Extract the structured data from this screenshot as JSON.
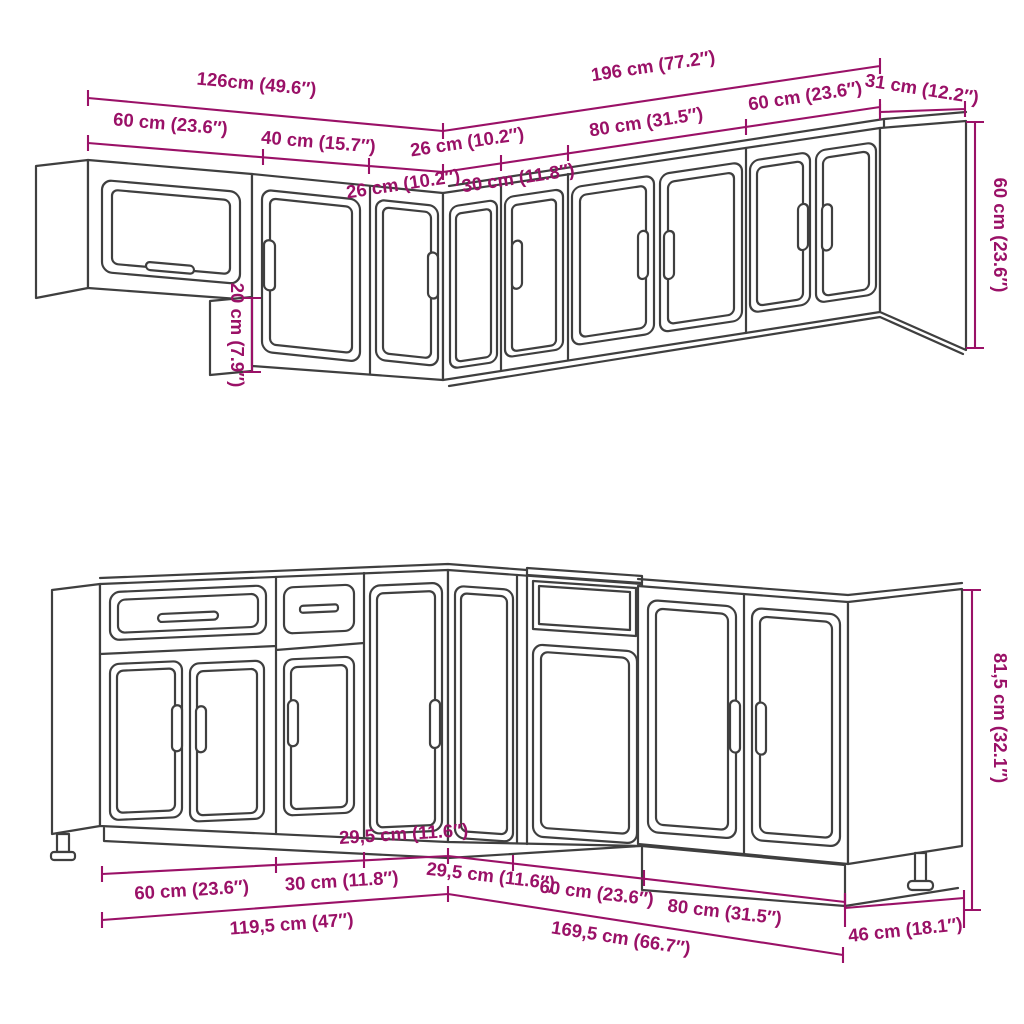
{
  "theme": {
    "dimension_color": "#9a1167",
    "line_art_color": "#3f3f3f",
    "background": "#ffffff"
  },
  "dimensions": {
    "top": {
      "overall_left": "126cm (49.6″)",
      "overall_right": "196 cm (77.2″)",
      "end_panel_depth": "31 cm (12.2″)",
      "seg_60_left": "60 cm (23.6″)",
      "seg_40": "40 cm (15.7″)",
      "seg_26_a": "26 cm (10.2″)",
      "seg_26_b": "26 cm (10.2″)",
      "seg_30": "30 cm (11.8″)",
      "seg_80": "80 cm (31.5″)",
      "seg_60_right": "60 cm (23.6″)",
      "height": "60 cm (23.6″)",
      "offset_height": "20 cm (7.9″)"
    },
    "bottom": {
      "seg_60_left": "60 cm (23.6″)",
      "seg_30": "30 cm (11.8″)",
      "seg_295_left": "29,5 cm (11.6″)",
      "seg_295_right": "29,5 cm (11.6″)",
      "seg_60_right": "60 cm (23.6″)",
      "seg_80": "80 cm (31.5″)",
      "overall_left": "119,5 cm (47″)",
      "overall_right": "169,5 cm (66.7″)",
      "depth": "46 cm (18.1″)",
      "height": "81,5 cm (32.1″)"
    }
  }
}
